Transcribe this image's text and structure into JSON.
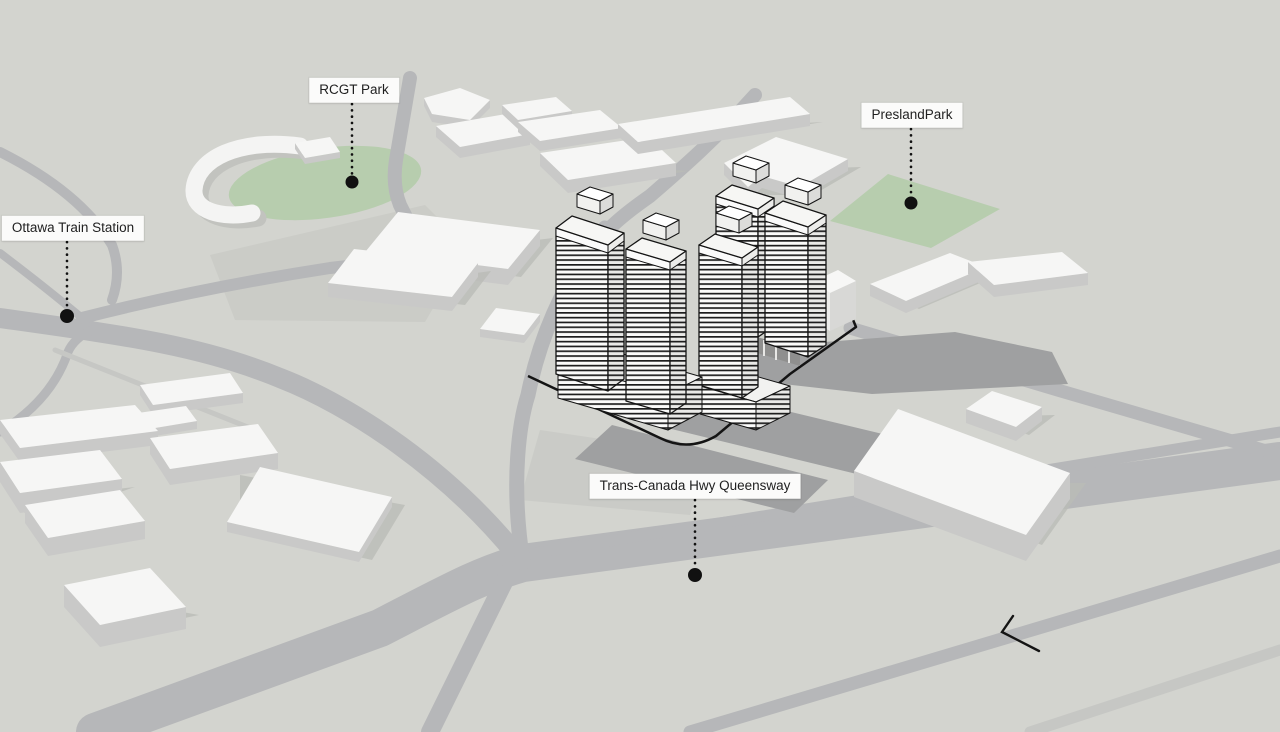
{
  "labels": {
    "ottawa_train_station": "Ottawa Train Station",
    "rcgt_park": "RCGT Park",
    "presland_park": "PreslandPark",
    "trans_canada": "Trans-Canada Hwy Queensway"
  },
  "colors": {
    "ground": "#d3d4cf",
    "road": "#b6b7b9",
    "road-light": "#c6c7c4",
    "apron": "#c9cac5",
    "park": "#b7cdae",
    "shadow": "#9fa0a1",
    "bldg-top": "#f6f6f5",
    "bldg-side": "#cbcbca",
    "bldg-shadow": "#babbb7",
    "outline": "#141414",
    "label-bg": "#fbfbfa",
    "label-text": "#1f1f1f"
  }
}
